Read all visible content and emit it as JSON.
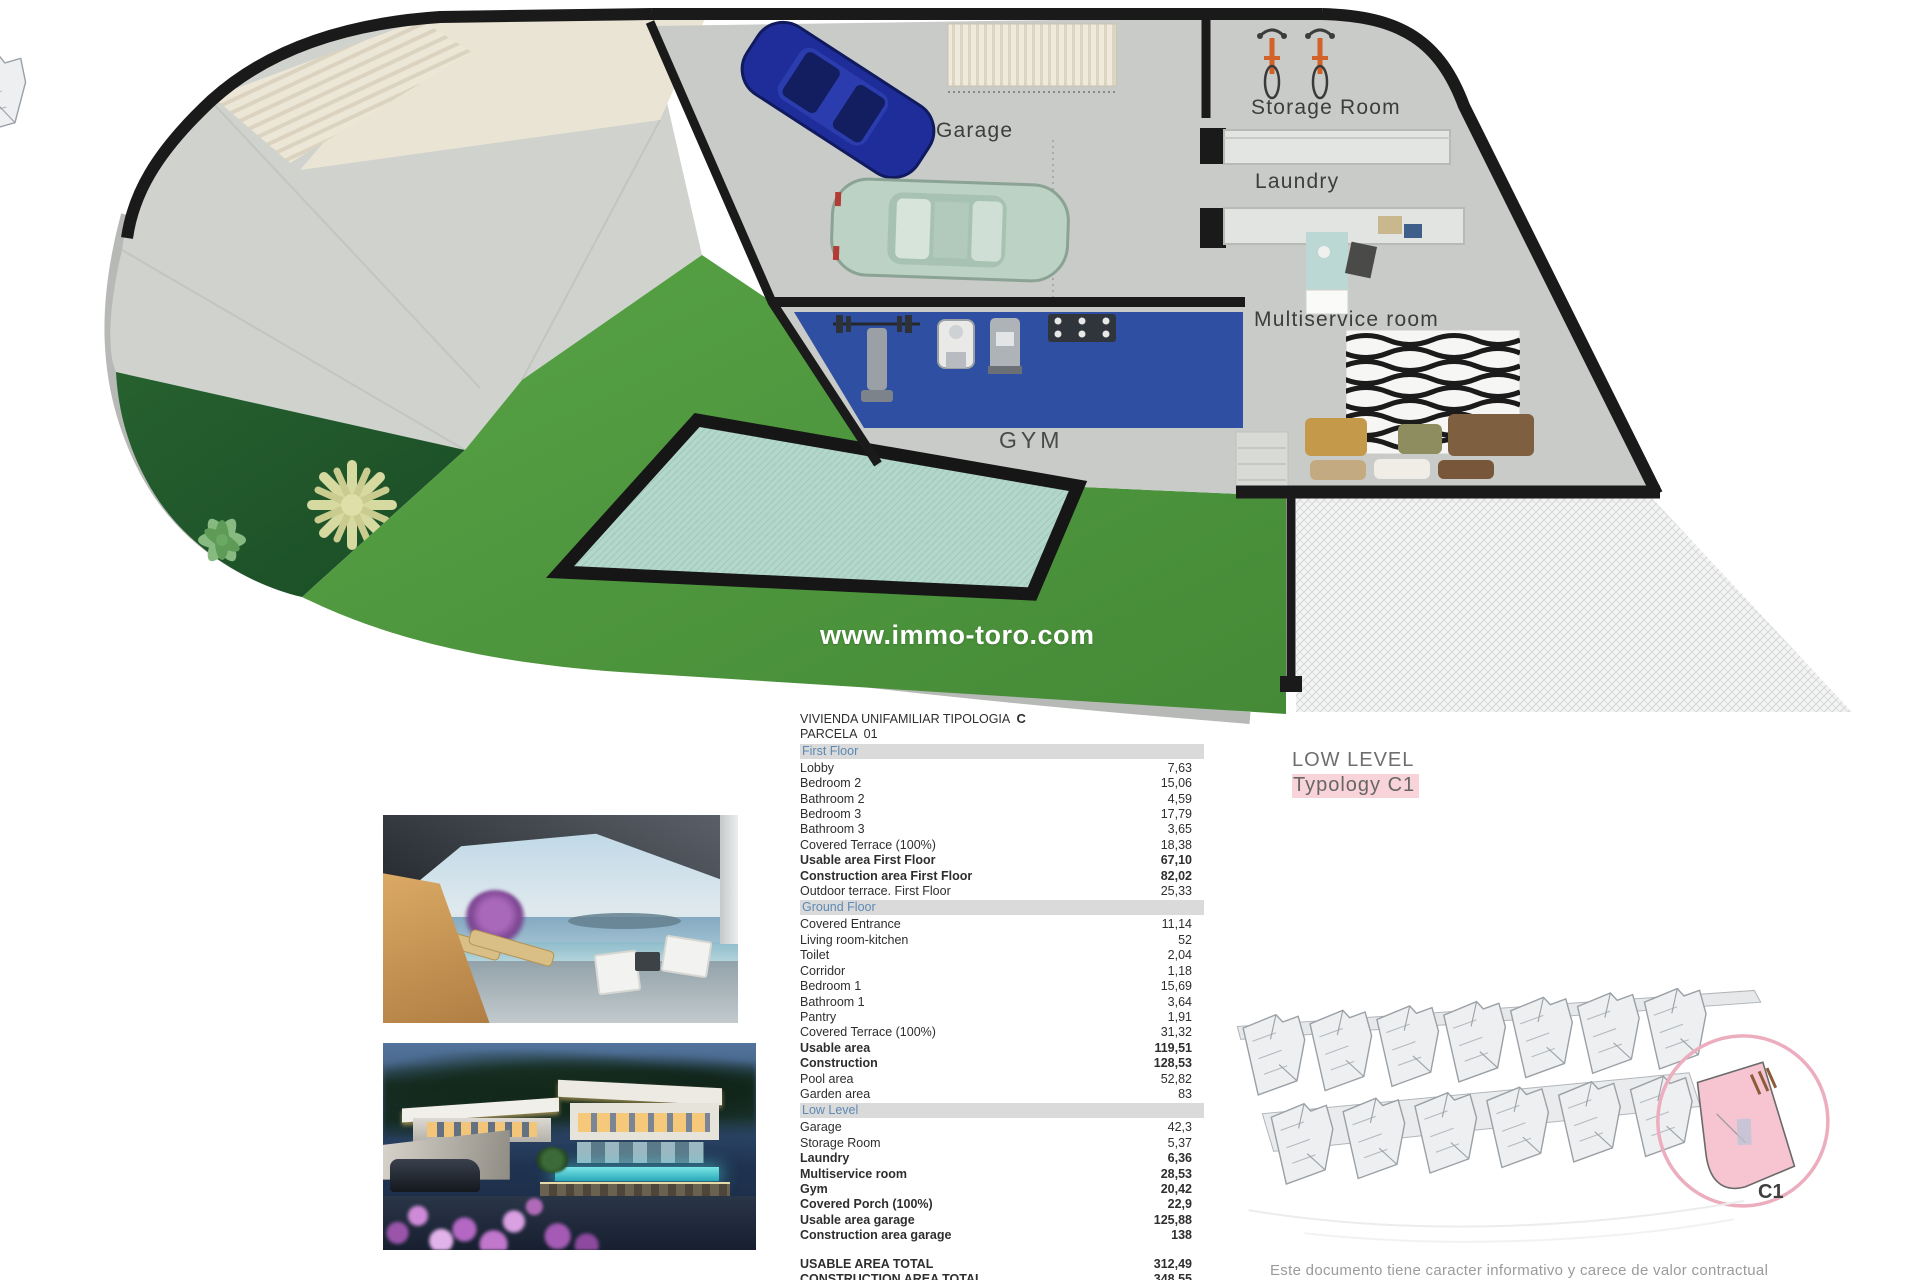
{
  "floor_plan": {
    "watermark": "www.immo-toro.com",
    "room_labels": {
      "garage": "Garage",
      "storage_room": "Storage Room",
      "laundry": "Laundry",
      "multiservice": "Multiservice room",
      "gym": "GYM"
    }
  },
  "level_caption": {
    "title": "LOW LEVEL",
    "subtitle": "Typology C1"
  },
  "area_table": {
    "title": "VIVIENDA UNIFAMILIAR TIPOLOGIA",
    "typology": "C",
    "parcel": "PARCELA  01",
    "sections": [
      {
        "header": "First Floor",
        "rows": [
          {
            "label": "Lobby",
            "value": "7,63",
            "bold": false
          },
          {
            "label": "Bedroom 2",
            "value": "15,06",
            "bold": false
          },
          {
            "label": "Bathroom 2",
            "value": "4,59",
            "bold": false
          },
          {
            "label": "Bedroom 3",
            "value": "17,79",
            "bold": false
          },
          {
            "label": "Bathroom 3",
            "value": "3,65",
            "bold": false
          },
          {
            "label": "Covered Terrace (100%)",
            "value": "18,38",
            "bold": false
          },
          {
            "label": "Usable area First Floor",
            "value": "67,10",
            "bold": true
          },
          {
            "label": "Construction area First Floor",
            "value": "82,02",
            "bold": true
          },
          {
            "label": "Outdoor terrace.  First Floor",
            "value": "25,33",
            "bold": false
          }
        ]
      },
      {
        "header": "Ground Floor",
        "rows": [
          {
            "label": "Covered Entrance",
            "value": "11,14",
            "bold": false
          },
          {
            "label": "Living room-kitchen",
            "value": "52",
            "bold": false
          },
          {
            "label": "Toilet",
            "value": "2,04",
            "bold": false
          },
          {
            "label": "Corridor",
            "value": "1,18",
            "bold": false
          },
          {
            "label": "Bedroom 1",
            "value": "15,69",
            "bold": false
          },
          {
            "label": "Bathroom 1",
            "value": "3,64",
            "bold": false
          },
          {
            "label": "Pantry",
            "value": "1,91",
            "bold": false
          },
          {
            "label": "Covered Terrace (100%)",
            "value": "31,32",
            "bold": false
          },
          {
            "label": "Usable area",
            "value": "119,51",
            "bold": true
          },
          {
            "label": "Construction",
            "value": "128,53",
            "bold": true
          },
          {
            "label": "Pool area",
            "value": "52,82",
            "bold": false
          },
          {
            "label": "Garden area",
            "value": "83",
            "bold": false
          }
        ]
      },
      {
        "header": "Low Level",
        "rows": [
          {
            "label": "Garage",
            "value": "42,3",
            "bold": false
          },
          {
            "label": "Storage Room",
            "value": "5,37",
            "bold": false
          },
          {
            "label": "Laundry",
            "value": "6,36",
            "bold": true
          },
          {
            "label": "Multiservice room",
            "value": "28,53",
            "bold": true
          },
          {
            "label": "Gym",
            "value": "20,42",
            "bold": true
          },
          {
            "label": "Covered Porch (100%)",
            "value": "22,9",
            "bold": true
          },
          {
            "label": "Usable area garage",
            "value": "125,88",
            "bold": true
          },
          {
            "label": "Construction area garage",
            "value": "138",
            "bold": true
          }
        ]
      }
    ],
    "totals": [
      {
        "label": "USABLE AREA TOTAL",
        "value": "312,49"
      },
      {
        "label": "CONSTRUCTION AREA TOTAL",
        "value": "348,55"
      }
    ]
  },
  "site_plan": {
    "highlight_label": "C1"
  },
  "disclaimer": "Este documento tiene caracter informativo y carece de valor contractual",
  "colors": {
    "highlight_pink": "#f8d4da",
    "lawn_green": "#4f9a40",
    "gym_mat_blue": "#2f4fa2",
    "pool_teal": "#b3d7ca",
    "wall_black": "#1a1a1a"
  }
}
